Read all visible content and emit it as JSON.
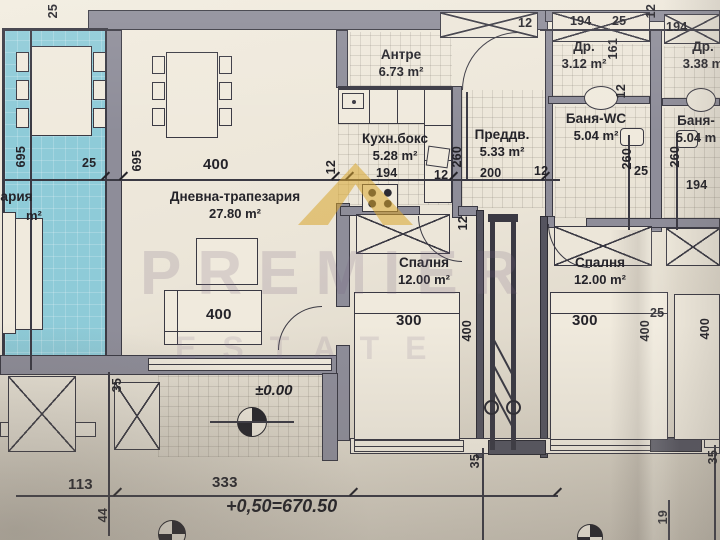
{
  "rooms": {
    "terrace": {
      "name": "трапезария",
      "area": "m²"
    },
    "living": {
      "name": "Дневна-трапезария",
      "area": "27.80 m²"
    },
    "antre": {
      "name": "Антре",
      "area": "6.73 m²"
    },
    "kitchen": {
      "name": "Кухн.бокс",
      "area": "5.28 m²"
    },
    "hall": {
      "name": "Преддв.",
      "area": "5.33 m²"
    },
    "closet1": {
      "name": "Др.",
      "area": "3.12 m²"
    },
    "bath1": {
      "name": "Баня-WC",
      "area": "5.04 m²"
    },
    "closet2": {
      "name": "Др.",
      "area": "3.38 m"
    },
    "bath2": {
      "name": "Баня-",
      "area": "5.04 m"
    },
    "bedroom1": {
      "name": "Спалня",
      "area": "12.00 m²"
    },
    "bedroom2": {
      "name": "Спалня",
      "area": "12.00 m²"
    }
  },
  "levels": {
    "zero": "±0.00",
    "entry": "+0,50=670.50"
  },
  "watermark": {
    "brand": "PREMIER",
    "sub": "ESTATE"
  },
  "dims": {
    "d12": "12",
    "d19": "19",
    "d25": "25",
    "d35": "35",
    "d44": "44",
    "d113": "113",
    "d161": "161",
    "d194": "194",
    "d200": "200",
    "d260": "260",
    "d300": "300",
    "d333": "333",
    "d400": "400",
    "d695": "695"
  }
}
